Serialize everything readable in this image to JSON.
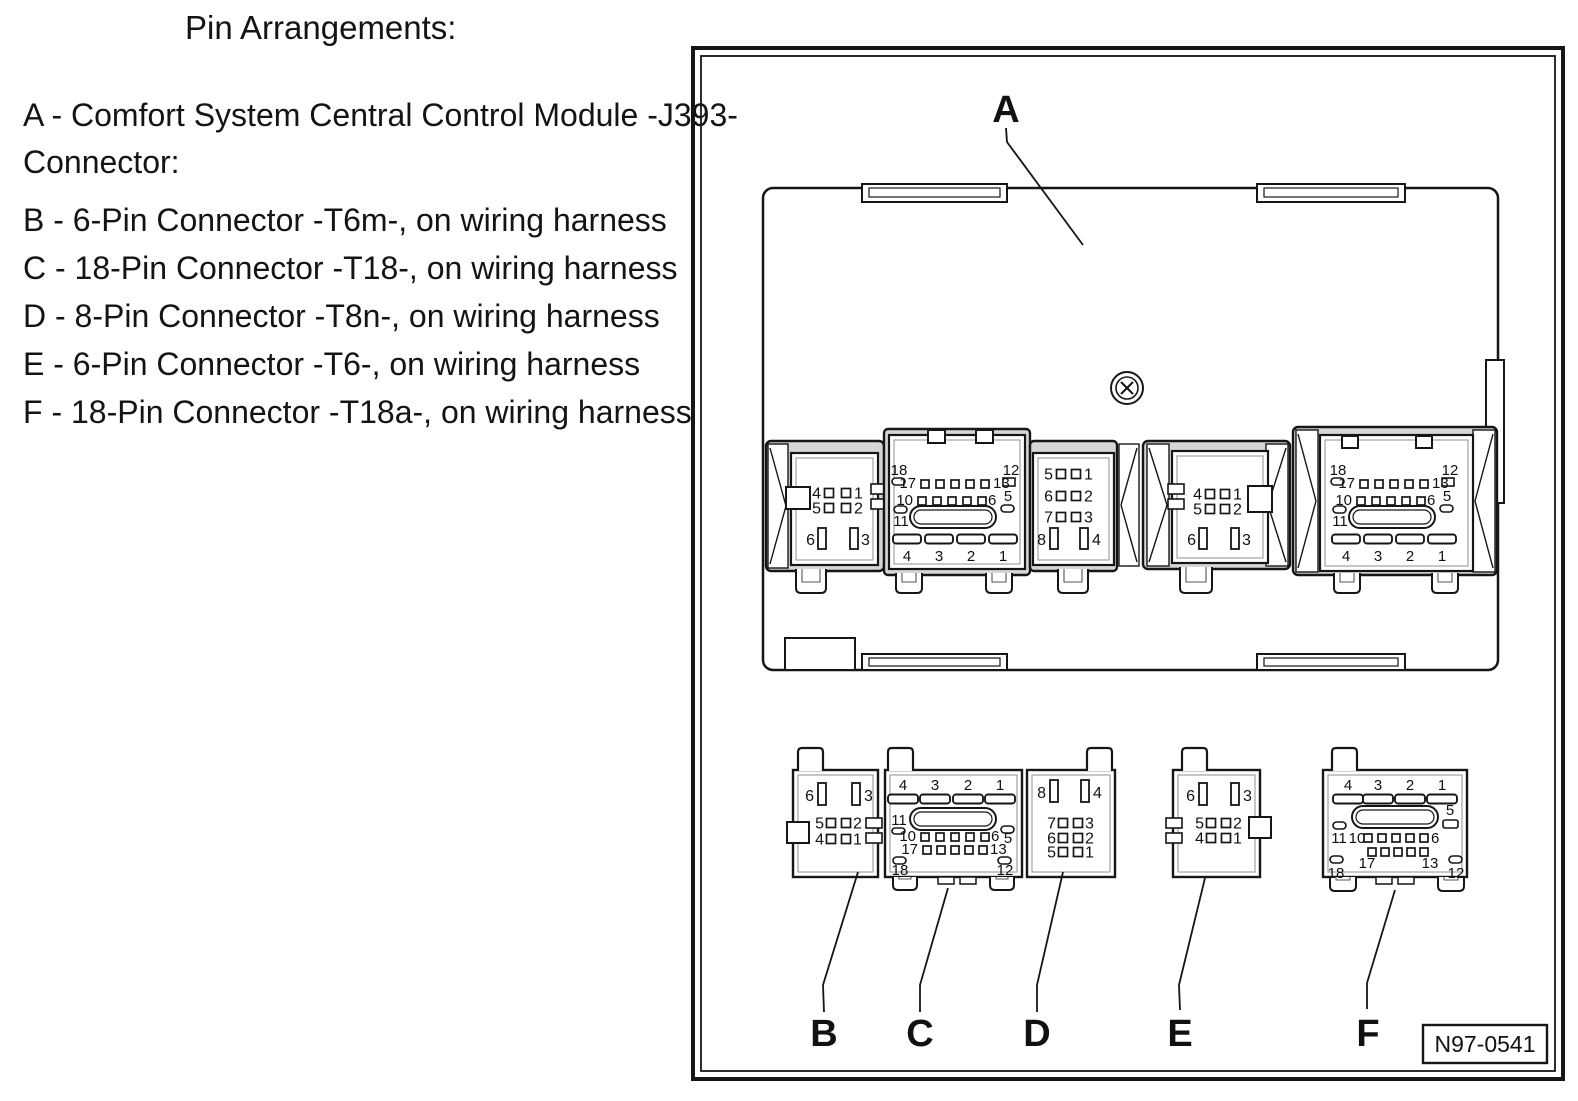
{
  "page": {
    "title": "Pin Arrangements:"
  },
  "legend": {
    "a1": "A - Comfort System Central Control Module -J393-",
    "a2": "Connector:",
    "b": "B - 6-Pin Connector -T6m-, on wiring harness",
    "c": "C - 18-Pin Connector -T18-, on wiring harness",
    "d": "D - 8-Pin Connector -T8n-, on wiring harness",
    "e": "E - 6-Pin Connector -T6-, on wiring harness",
    "f": "F - 18-Pin Connector -T18a-, on wiring harness"
  },
  "diagram": {
    "figure_ref": "N97-0541",
    "module": {
      "label": "A",
      "sockets": {
        "b6": {
          "rows": [
            [
              "4",
              "1"
            ],
            [
              "5",
              "2"
            ],
            [
              "6",
              "3"
            ]
          ]
        },
        "c18": {
          "tl": "18",
          "tr": "12",
          "r1l": "17",
          "r1r": "13",
          "r2l": "10",
          "r2r": "6",
          "p5": "5",
          "p11": "11",
          "blades": [
            "4",
            "3",
            "2",
            "1"
          ]
        },
        "d8": {
          "rows": [
            [
              "5",
              "1"
            ],
            [
              "6",
              "2"
            ],
            [
              "7",
              "3"
            ],
            [
              "8",
              "4"
            ]
          ]
        },
        "e6": {
          "rows": [
            [
              "4",
              "1"
            ],
            [
              "5",
              "2"
            ],
            [
              "6",
              "3"
            ]
          ]
        },
        "f18": {
          "tl": "18",
          "tr": "12",
          "r1l": "17",
          "r1r": "13",
          "r2l": "10",
          "r2r": "6",
          "p5": "5",
          "p11": "11",
          "blades": [
            "4",
            "3",
            "2",
            "1"
          ]
        }
      }
    },
    "plugs": {
      "b": {
        "label": "B",
        "rows": [
          [
            "6",
            "3"
          ],
          [
            "5",
            "2"
          ],
          [
            "4",
            "1"
          ]
        ]
      },
      "c": {
        "label": "C",
        "blades": [
          "4",
          "3",
          "2",
          "1"
        ],
        "p11": "11",
        "r2l": "10",
        "r2r": "6",
        "p5": "5",
        "r3l": "17",
        "r3r": "13",
        "bl": "18",
        "br": "12"
      },
      "d": {
        "label": "D",
        "rows": [
          [
            "8",
            "4"
          ],
          [
            "7",
            "3"
          ],
          [
            "6",
            "2"
          ],
          [
            "5",
            "1"
          ]
        ]
      },
      "e": {
        "label": "E",
        "rows": [
          [
            "6",
            "3"
          ],
          [
            "5",
            "2"
          ],
          [
            "4",
            "1"
          ]
        ]
      },
      "f": {
        "label": "F",
        "blades": [
          "4",
          "3",
          "2",
          "1"
        ],
        "p5": "5",
        "r2l": "11",
        "r2l2": "10",
        "r2r": "6",
        "r3l": "17",
        "r3r": "13",
        "bl": "18",
        "br": "12"
      }
    }
  }
}
